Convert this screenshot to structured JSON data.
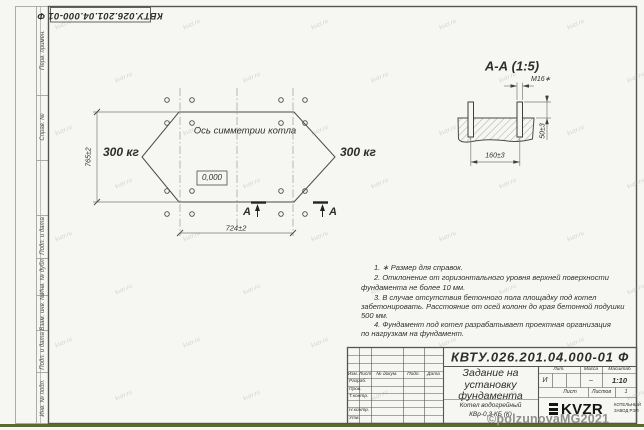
{
  "colors": {
    "sheet_background": "#f6f6f3",
    "line_color": "#3f3f3f",
    "thin_line_color": "#8b8b8b",
    "bottom_strip_green": "#5c6b24",
    "watermark_gray": "#969691",
    "copyright_gray": "#8f8f8d",
    "logo_black": "#141414"
  },
  "corner_stamp": {
    "doc_number": "КВТУ.026.201.04.000-01 Ф"
  },
  "left_strip": {
    "labels": [
      "Перв. примен.",
      "Справ. №",
      "",
      "Подп. и дата",
      "Инв. № дубл.",
      "Взам. инв. №",
      "Подп. и дата",
      "Инв. № подл."
    ]
  },
  "plan": {
    "symmetry_axis_label": "Ось симметрии котла",
    "load_left": "300 кг",
    "load_right": "300 кг",
    "elevation_mark": "0,000",
    "dim_height": "765±2",
    "dim_width": "724±2",
    "section_letter_left": "А",
    "section_letter_right": "А"
  },
  "section_view": {
    "title": "А-А (1:5)",
    "bolt_thread": "М16∗",
    "dim_bolt_spacing": "160±3",
    "dim_protrusion": "50±3"
  },
  "notes": {
    "lines": [
      "1. ∗ Размер для справок.",
      "2. Отклонение от горизонтального уровня верхней поверхности",
      "фундамента не более 10 мм.",
      "3. В случае отсутствия бетонного пола площадку под котел",
      "забетонировать. Расстояние от осей колонн до края бетонной подушки",
      "500 мм.",
      "4. Фундамент под котел разрабатывает проектная организация",
      "по нагрузкам на фундамент."
    ]
  },
  "title_block": {
    "doc_number": "КВТУ.026.201.04.000-01 Ф",
    "project_title_lines": [
      "Задание на",
      "установку",
      "фундамента"
    ],
    "product_lines": [
      "Котел водогрейный",
      "КВр-0,3 КБ (К)"
    ],
    "col_headers": {
      "izm": "Изм.",
      "list": "Лист",
      "doc": "№ докум.",
      "podp": "Подп.",
      "data": "Дата"
    },
    "row_labels": {
      "razrab": "Разраб.",
      "prov": "Пров.",
      "tkontr": "Т.контр.",
      "nkontr": "Н.контр.",
      "utv": "Утв."
    },
    "lit_header": "Лит.",
    "lit_value": "И",
    "mass_header": "Масса",
    "mass_value": "–",
    "scale_header": "Масштаб",
    "scale_value": "1:10",
    "sheet_label": "Лист",
    "sheets_label": "Листов",
    "sheets_value": "1",
    "logo_text": "KVZR",
    "logo_caption_lines": [
      "КОТЕЛЬНЫЙ",
      "ЗАВОД РЭП"
    ]
  },
  "watermarks": {
    "copyright": "©polzunovaMG2021",
    "diagonal": "kvzr.ru"
  }
}
